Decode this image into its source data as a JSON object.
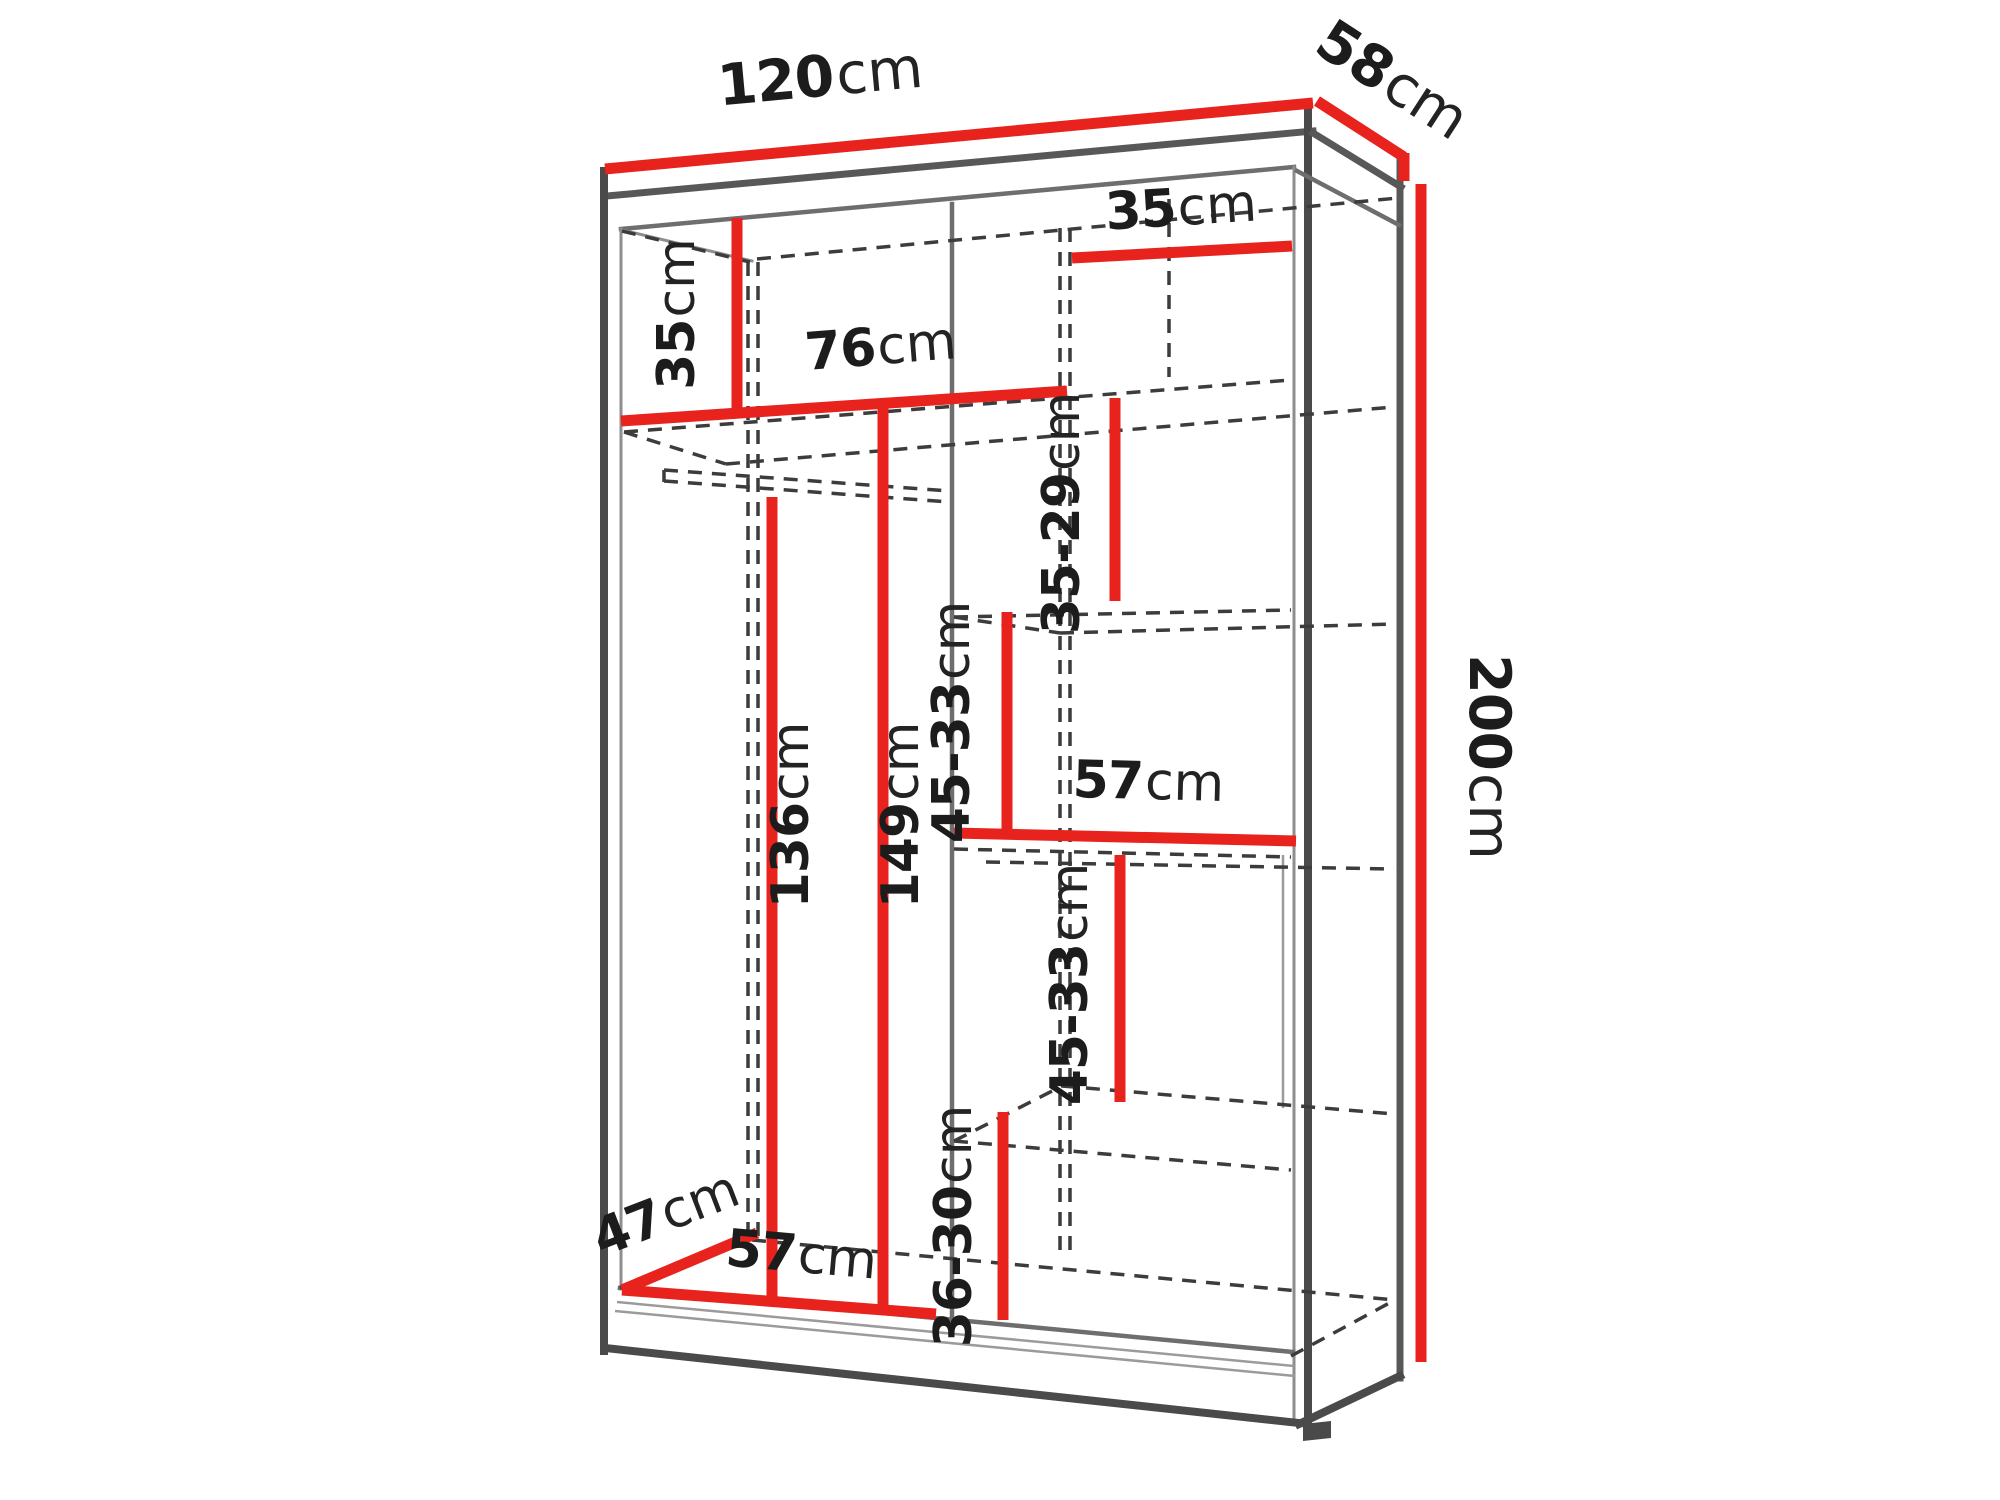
{
  "diagram": {
    "type": "furniture-dimension-diagram",
    "subject": "sliding-door wardrobe with interior measurements",
    "units": "cm",
    "colors": {
      "accent_red": "#e8231d",
      "carcass_line": "#4a4a4a",
      "hidden_line_dashed": "#3c3c3c",
      "text": "#1c1c1c",
      "background": "#ffffff"
    },
    "dimensions": {
      "top_width": {
        "value": "120",
        "unit": "cm"
      },
      "top_depth": {
        "value": "58",
        "unit": "cm"
      },
      "height": {
        "value": "200",
        "unit": "cm"
      },
      "left_top_shelf_height": {
        "value": "35",
        "unit": "cm"
      },
      "left_compartment_width": {
        "value": "76",
        "unit": "cm"
      },
      "right_top_shelf_width": {
        "value": "35",
        "unit": "cm"
      },
      "right_gap_top": {
        "value": "35-29",
        "unit": "cm"
      },
      "hanging_clearance": {
        "value": "136",
        "unit": "cm"
      },
      "left_interior_height": {
        "value": "149",
        "unit": "cm"
      },
      "right_gap_upper": {
        "value": "45-33",
        "unit": "cm"
      },
      "middle_shelf_width": {
        "value": "57",
        "unit": "cm"
      },
      "right_gap_lower": {
        "value": "45-33",
        "unit": "cm"
      },
      "right_gap_bottom": {
        "value": "36-30",
        "unit": "cm"
      },
      "interior_depth": {
        "value": "47",
        "unit": "cm"
      },
      "bottom_shelf_width": {
        "value": "57",
        "unit": "cm"
      }
    }
  }
}
